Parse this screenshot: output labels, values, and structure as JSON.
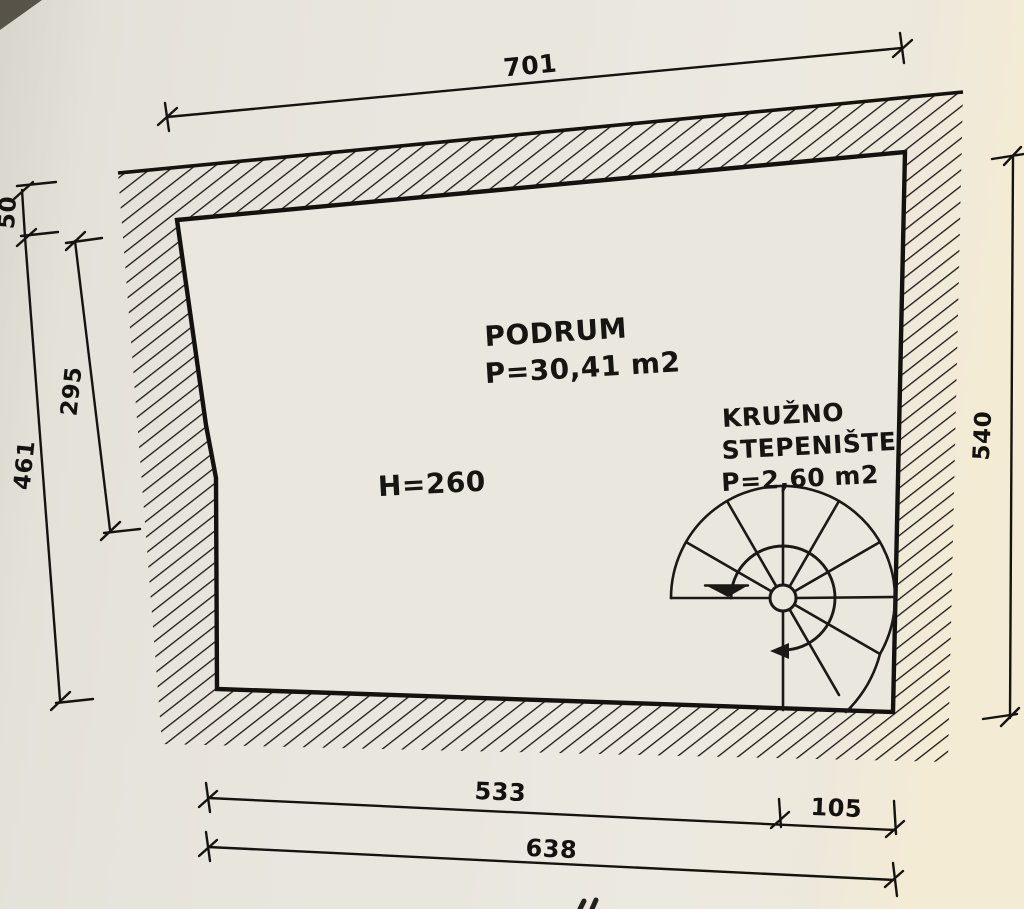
{
  "plan": {
    "room": {
      "label": "PODRUM",
      "area": "P=30,41 m2",
      "ceiling_height": "H=260"
    },
    "staircase": {
      "label_line1": "KRUŽNO",
      "label_line2": "STEPENIŠTE",
      "area": "P=2,60 m2"
    },
    "dimensions": {
      "top_width": "701",
      "left_top": "50",
      "left_middle": "295",
      "left_total": "461",
      "right_height": "540",
      "bottom_room": "533",
      "bottom_stair": "105",
      "bottom_total": "638"
    },
    "colors": {
      "ink": "#1d1b17",
      "paper": "#e9e6de"
    }
  }
}
